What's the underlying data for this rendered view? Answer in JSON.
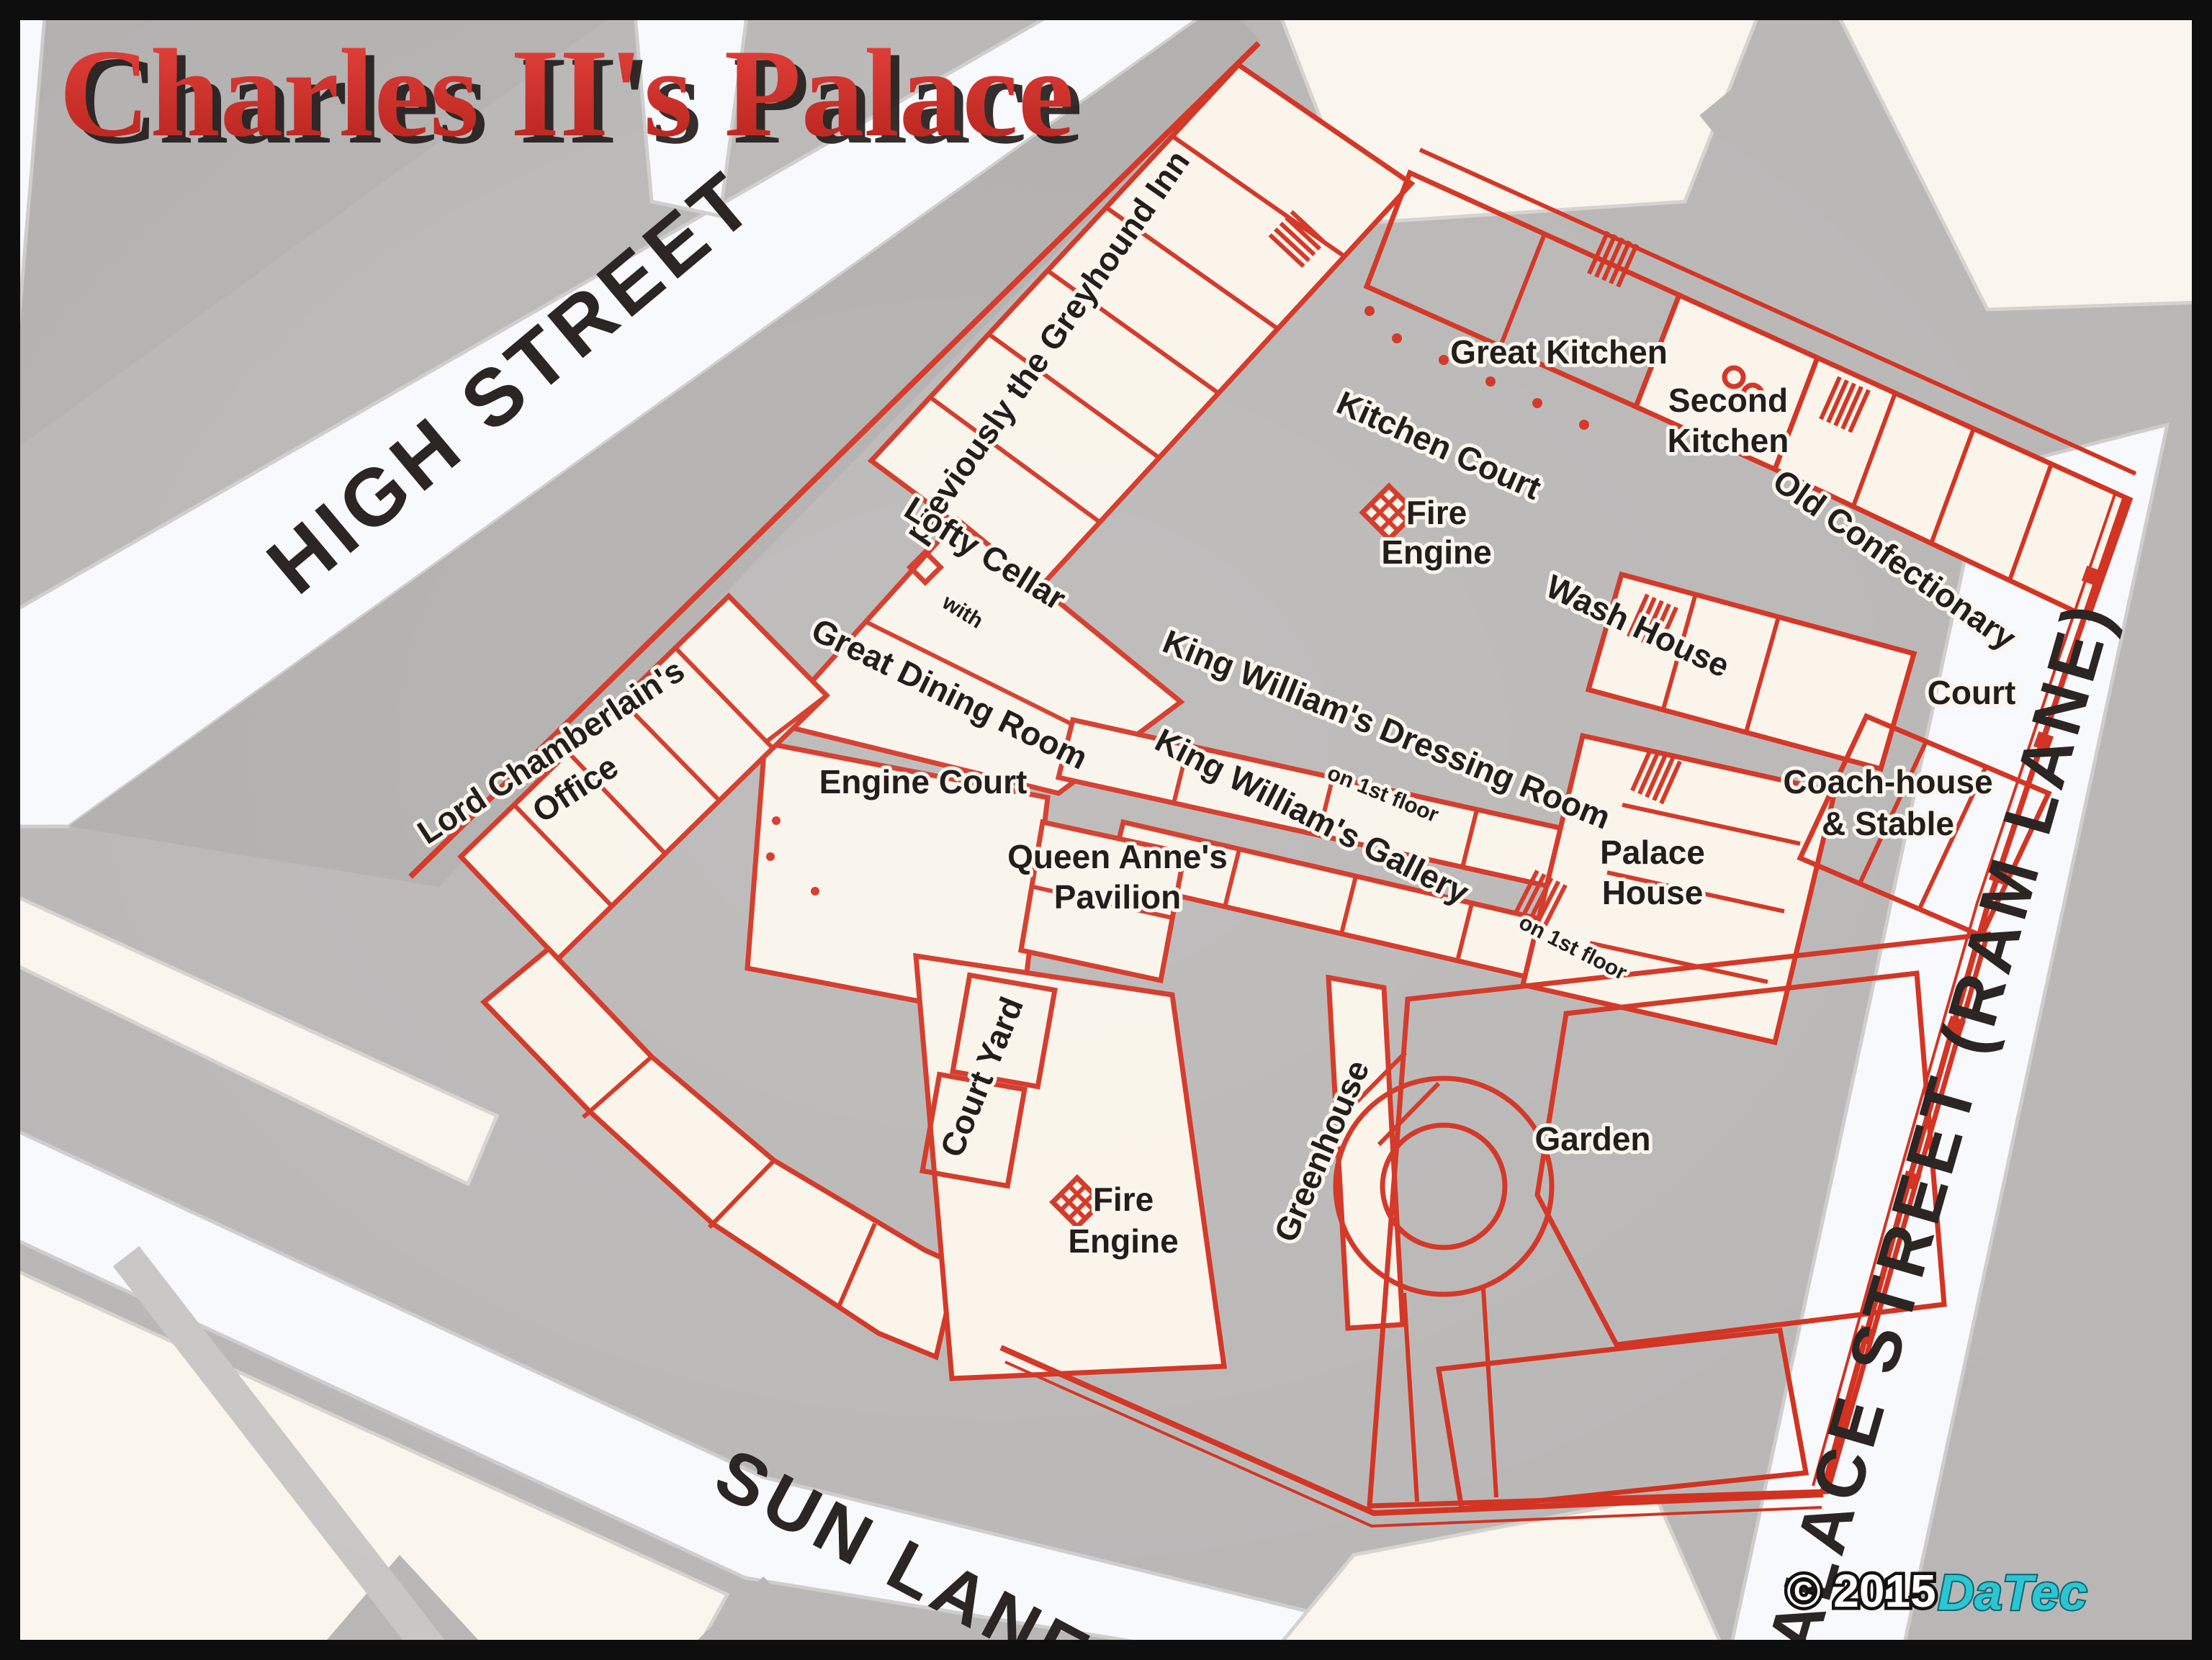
{
  "page": {
    "title": "Charles II's Palace",
    "copyright": "© 2015",
    "brand": "DaTec"
  },
  "colors": {
    "background_gray": "#b9b7b6",
    "building_cream": "#faf4ea",
    "town_block_cream": "#faf6ee",
    "street_white": "#f8f9fc",
    "plan_red": "#d2301f",
    "label_black": "#231e1b",
    "title_red": "#d93531",
    "brand_teal": "#2cc5d2"
  },
  "streets": {
    "high_street": "HIGH STREET",
    "sun_lane": "SUN LANE",
    "palace_street": "PALACE STREET (RAM LANE)"
  },
  "labels": {
    "greyhound": "previously the Greyhound Inn",
    "great_kitchen": "Great Kitchen",
    "second_kitchen": {
      "line1": "Second",
      "line2": "Kitchen"
    },
    "old_confectionary": "Old Confectionary",
    "kitchen_court": "Kitchen Court",
    "fire_engine": {
      "line1": "Fire",
      "line2": "Engine"
    },
    "lofty_cellar": "Lofty Cellar",
    "with_word": "with",
    "great_dining_room": "Great Dining Room",
    "wash_house": "Wash House",
    "court": "Court",
    "kw_dressing": "King William's Dressing Room",
    "kw_gallery": "King William's Gallery",
    "first_floor": "on 1st floor",
    "lord_chamberlain": {
      "line1": "Lord Chamberlain's",
      "line2": "Office"
    },
    "engine_court": "Engine Court",
    "queen_anne": {
      "line1": "Queen Anne's",
      "line2": "Pavilion"
    },
    "palace_house": {
      "line1": "Palace",
      "line2": "House"
    },
    "coach_house": {
      "line1": "Coach-house",
      "line2": "& Stable"
    },
    "court_yard": "Court Yard",
    "greenhouse": "Greenhouse",
    "garden": "Garden"
  }
}
